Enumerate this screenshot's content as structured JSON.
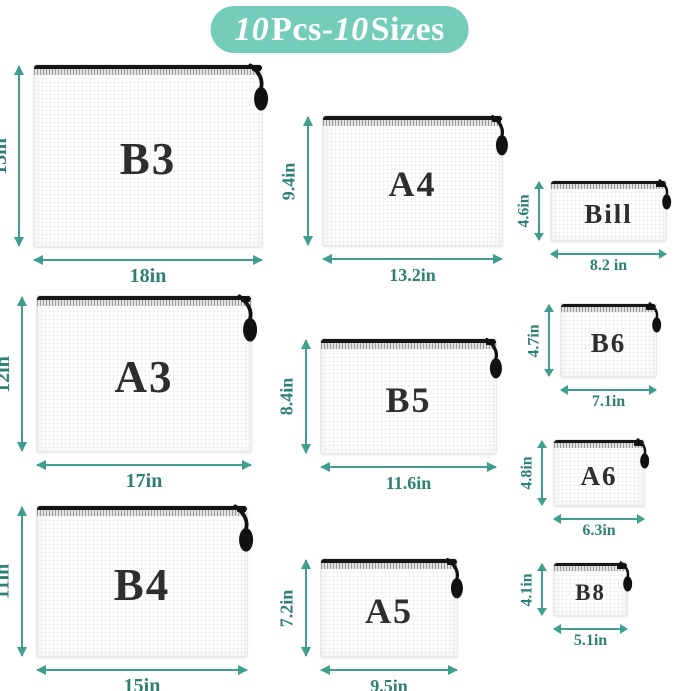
{
  "badge": {
    "num1": "10",
    "mid": "Pcs-",
    "num2": "10",
    "end": "Sizes"
  },
  "colors": {
    "badge_background": "#74ccba",
    "dimension_arrow": "#3f9e8d",
    "dimension_text": "#2d8173",
    "zipper_black": "#161616",
    "pouch_label_text": "#2e2e2e",
    "pouch_body": "#ffffff"
  },
  "pouches": [
    {
      "label": "B3",
      "height_label": "13in",
      "width_label": "18in"
    },
    {
      "label": "A3",
      "height_label": "12in",
      "width_label": "17in"
    },
    {
      "label": "B4",
      "height_label": "11in",
      "width_label": "15in"
    },
    {
      "label": "A4",
      "height_label": "9.4in",
      "width_label": "13.2in"
    },
    {
      "label": "B5",
      "height_label": "8.4in",
      "width_label": "11.6in"
    },
    {
      "label": "A5",
      "height_label": "7.2in",
      "width_label": "9.5in"
    },
    {
      "label": "Bill",
      "height_label": "4.6in",
      "width_label": "8.2 in"
    },
    {
      "label": "B6",
      "height_label": "4.7in",
      "width_label": "7.1in"
    },
    {
      "label": "A6",
      "height_label": "4.8in",
      "width_label": "6.3in"
    },
    {
      "label": "B8",
      "height_label": "4.1in",
      "width_label": "5.1in"
    }
  ]
}
